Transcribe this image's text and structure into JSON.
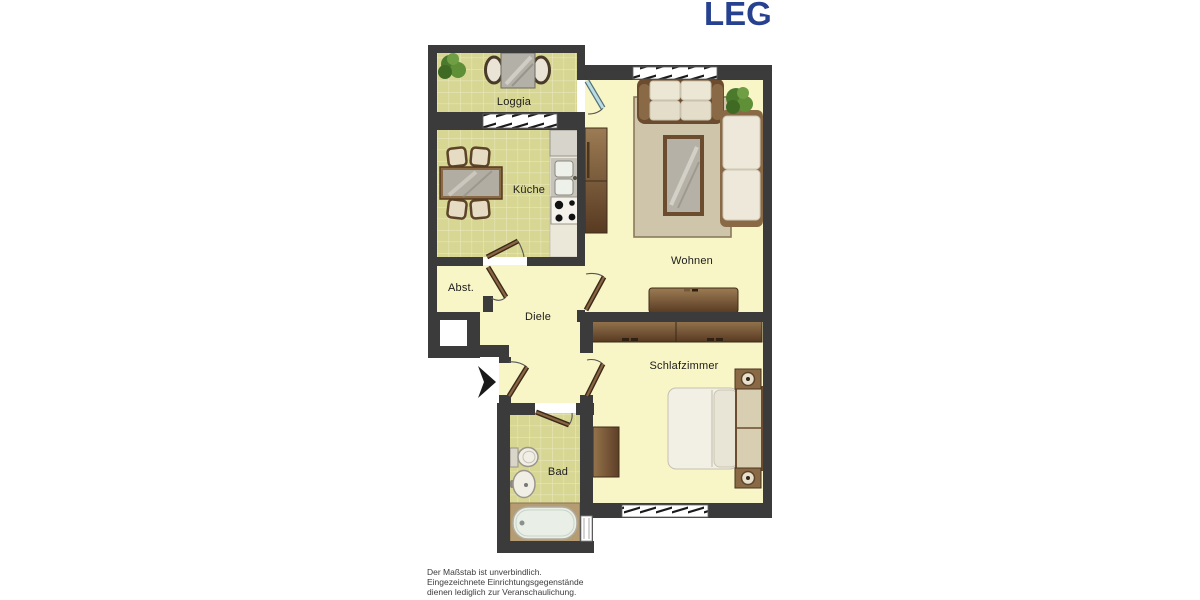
{
  "logo": {
    "text": "LEG",
    "color": "#26418f"
  },
  "plan": {
    "rooms": [
      {
        "id": "loggia",
        "label": "Loggia"
      },
      {
        "id": "kueche",
        "label": "Küche"
      },
      {
        "id": "wohnen",
        "label": "Wohnen"
      },
      {
        "id": "abstellraum",
        "label": "Abst."
      },
      {
        "id": "diele",
        "label": "Diele"
      },
      {
        "id": "schlafzimmer",
        "label": "Schlafzimmer"
      },
      {
        "id": "bad",
        "label": "Bad"
      }
    ],
    "colors": {
      "wall": "#3b3b3b",
      "floor": "#f8f5c6",
      "tile": "#d7d693",
      "tile_grout": "#e9e7bb",
      "furniture_brown": "#7a5a38",
      "rug": "#cec5ab",
      "glass_door": "#b9dde2",
      "logo_blue": "#26418f"
    }
  },
  "disclaimer": {
    "lines": [
      "Der Maßstab ist unverbindlich.",
      "Eingezeichnete Einrichtungsgegenstände",
      "dienen lediglich zur Veranschaulichung."
    ]
  }
}
